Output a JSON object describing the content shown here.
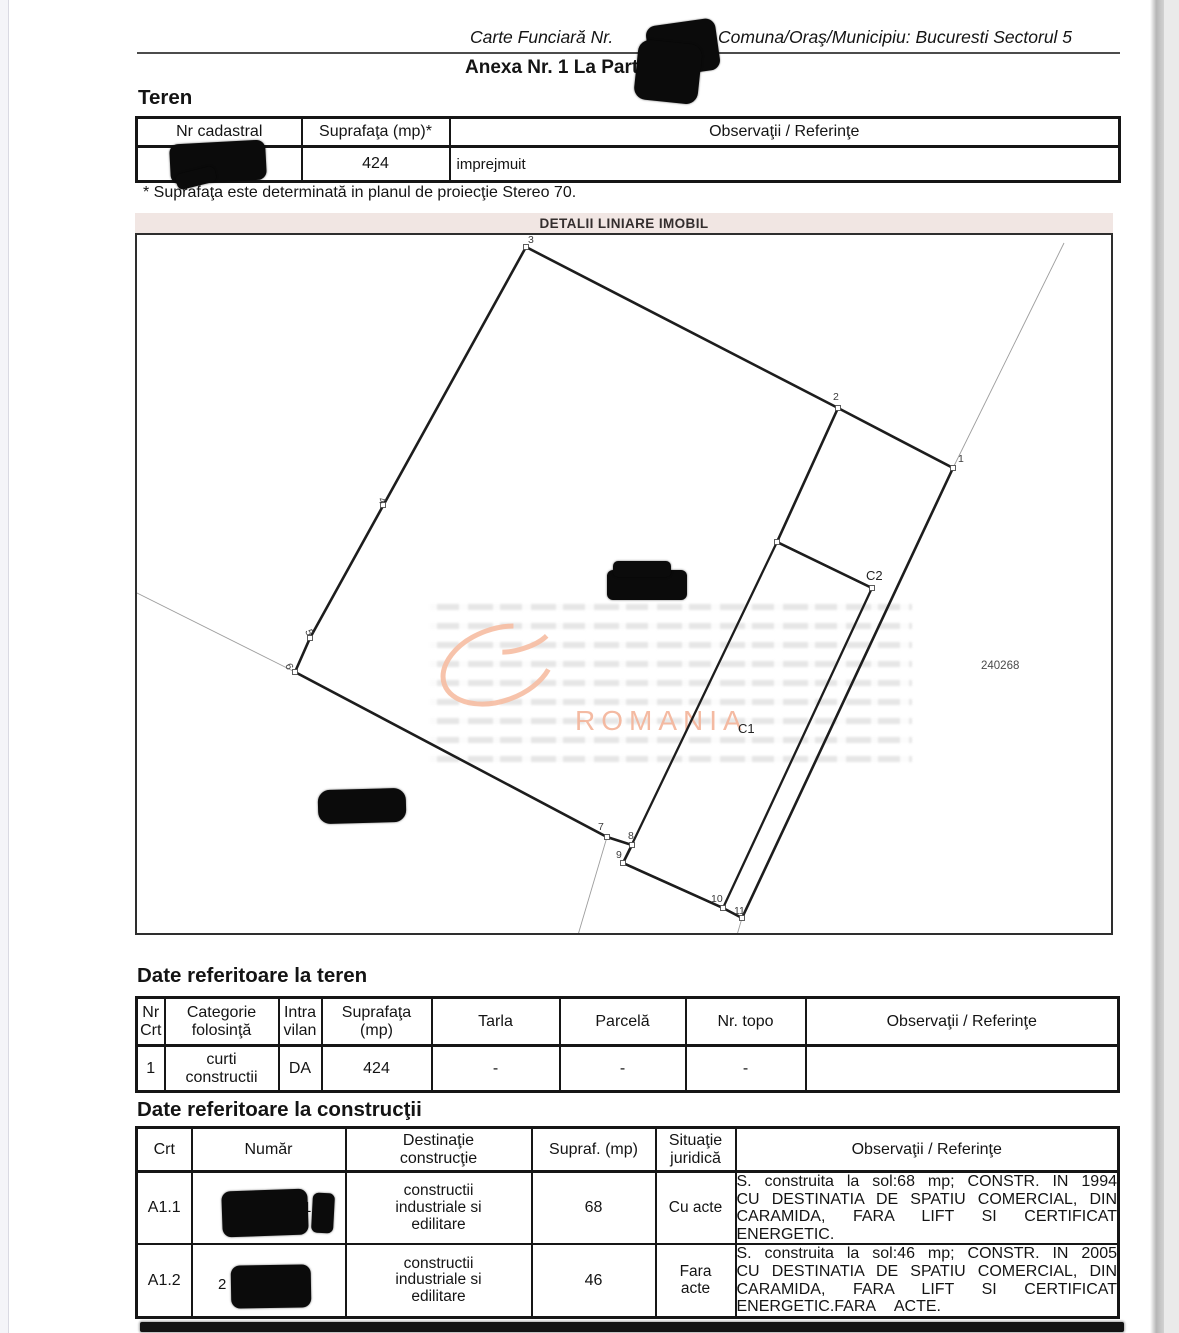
{
  "header": {
    "carte_funciara_label": "Carte Funciară Nr.",
    "comuna_label": "Comuna/Oraş/Municipiu: Bucuresti Sectorul 5",
    "anexa_title": "Anexa Nr. 1 La Partea I"
  },
  "teren": {
    "heading": "Teren",
    "table": {
      "headers": [
        "Nr cadastral",
        "Suprafaţa (mp)*",
        "Observaţii / Referinţe"
      ],
      "row": {
        "suprafata": "424",
        "observatii": "imprejmuit"
      }
    },
    "footnote": "* Suprafaţa este determinată in planul de proiecţie Stereo 70."
  },
  "plan": {
    "title": "DETALII LINIARE IMOBIL",
    "watermark_text": "ROMANIA",
    "ref_number": "240268",
    "geometry": {
      "boundary": [
        [
          391,
          14
        ],
        [
          175,
          405
        ],
        [
          160,
          439
        ],
        [
          472,
          604
        ],
        [
          497,
          612
        ],
        [
          488,
          630
        ],
        [
          588,
          675
        ],
        [
          607,
          685
        ],
        [
          818,
          235
        ],
        [
          703,
          175
        ]
      ],
      "c1": [
        [
          642,
          309
        ],
        [
          737,
          355
        ],
        [
          588,
          675
        ],
        [
          488,
          630
        ]
      ],
      "c2_wall": [
        [
          703,
          175
        ],
        [
          642,
          309
        ],
        [
          737,
          355
        ]
      ],
      "thin_lines": [
        [
          [
            929,
            10
          ],
          [
            818,
            235
          ]
        ],
        [
          [
            0,
            359
          ],
          [
            160,
            439
          ]
        ],
        [
          [
            472,
            604
          ],
          [
            443,
            702
          ]
        ],
        [
          [
            607,
            685
          ],
          [
            602,
            702
          ]
        ]
      ],
      "markers": [
        [
          818,
          235
        ],
        [
          703,
          175
        ],
        [
          391,
          14
        ],
        [
          248,
          272
        ],
        [
          175,
          405
        ],
        [
          160,
          439
        ],
        [
          472,
          604
        ],
        [
          497,
          612
        ],
        [
          488,
          630
        ],
        [
          588,
          675
        ],
        [
          607,
          685
        ],
        [
          642,
          309
        ],
        [
          737,
          355
        ]
      ],
      "point_labels": [
        {
          "t": "1",
          "x": 823,
          "y": 229,
          "r": 0
        },
        {
          "t": "2",
          "x": 698,
          "y": 167,
          "r": 0
        },
        {
          "t": "3",
          "x": 393,
          "y": 10,
          "r": 0
        },
        {
          "t": "4",
          "x": 243,
          "y": 266,
          "r": 68
        },
        {
          "t": "5",
          "x": 170,
          "y": 398,
          "r": 68
        },
        {
          "t": "6",
          "x": 150,
          "y": 432,
          "r": 68
        },
        {
          "t": "7",
          "x": 463,
          "y": 597,
          "r": 0
        },
        {
          "t": "8",
          "x": 493,
          "y": 606,
          "r": 0
        },
        {
          "t": "9",
          "x": 481,
          "y": 625,
          "r": 0
        },
        {
          "t": "10",
          "x": 576,
          "y": 669,
          "r": 0
        },
        {
          "t": "11",
          "x": 599,
          "y": 681,
          "r": 0
        }
      ],
      "building_labels": [
        {
          "t": "C2",
          "x": 731,
          "y": 347
        },
        {
          "t": "C1",
          "x": 603,
          "y": 500
        }
      ],
      "ref_pos": {
        "x": 846,
        "y": 436
      },
      "watermark": {
        "ellipse": {
          "cx": 363,
          "cy": 432,
          "rx": 57,
          "ry": 36,
          "rot": -20,
          "dash": "225 71",
          "offset": -25
        },
        "arc2": {
          "cx": 385,
          "cy": 404,
          "rx": 32,
          "ry": 12,
          "rot": -18,
          "dash": "48 160",
          "offset": -10
        },
        "text_x": 440,
        "text_y": 497
      }
    }
  },
  "teren_details": {
    "heading": "Date referitoare la teren",
    "headers": [
      "Nr\nCrt",
      "Categorie\nfolosinţă",
      "Intra\nvilan",
      "Suprafaţa\n(mp)",
      "Tarla",
      "Parcelă",
      "Nr. topo",
      "Observaţii / Referinţe"
    ],
    "row": [
      "1",
      "curti\nconstructii",
      "DA",
      "424",
      "-",
      "-",
      "-",
      ""
    ]
  },
  "constructii": {
    "heading": "Date referitoare la construcţii",
    "headers": [
      "Crt",
      "Număr",
      "Destinaţie\nconstrucţie",
      "Supraf. (mp)",
      "Situaţie\njuridică",
      "Observaţii / Referinţe"
    ],
    "rows": [
      {
        "crt": "A1.1",
        "numar_peek_digit": "1",
        "destinatie": "constructii\nindustriale si\nedilitare",
        "suprafata": "68",
        "situatie": "Cu acte",
        "observatii_lines": [
          "S. construita la sol:68 mp; CONSTR. IN 1994",
          "CU DESTINATIA DE SPATIU COMERCIAL, DIN",
          "CARAMIDA, FARA LIFT SI CERTIFICAT",
          "ENERGETIC."
        ]
      },
      {
        "crt": "A1.2",
        "numar_peek_digit": "2",
        "destinatie": "constructii\nindustriale si\nedilitare",
        "suprafata": "46",
        "situatie": "Fara\nacte",
        "observatii_lines": [
          "S. construita la sol:46 mp; CONSTR. IN 2005",
          "CU DESTINATIA DE SPATIU COMERCIAL, DIN",
          "CARAMIDA, FARA LIFT SI CERTIFICAT",
          "ENERGETIC.FARA    ACTE."
        ]
      }
    ]
  }
}
